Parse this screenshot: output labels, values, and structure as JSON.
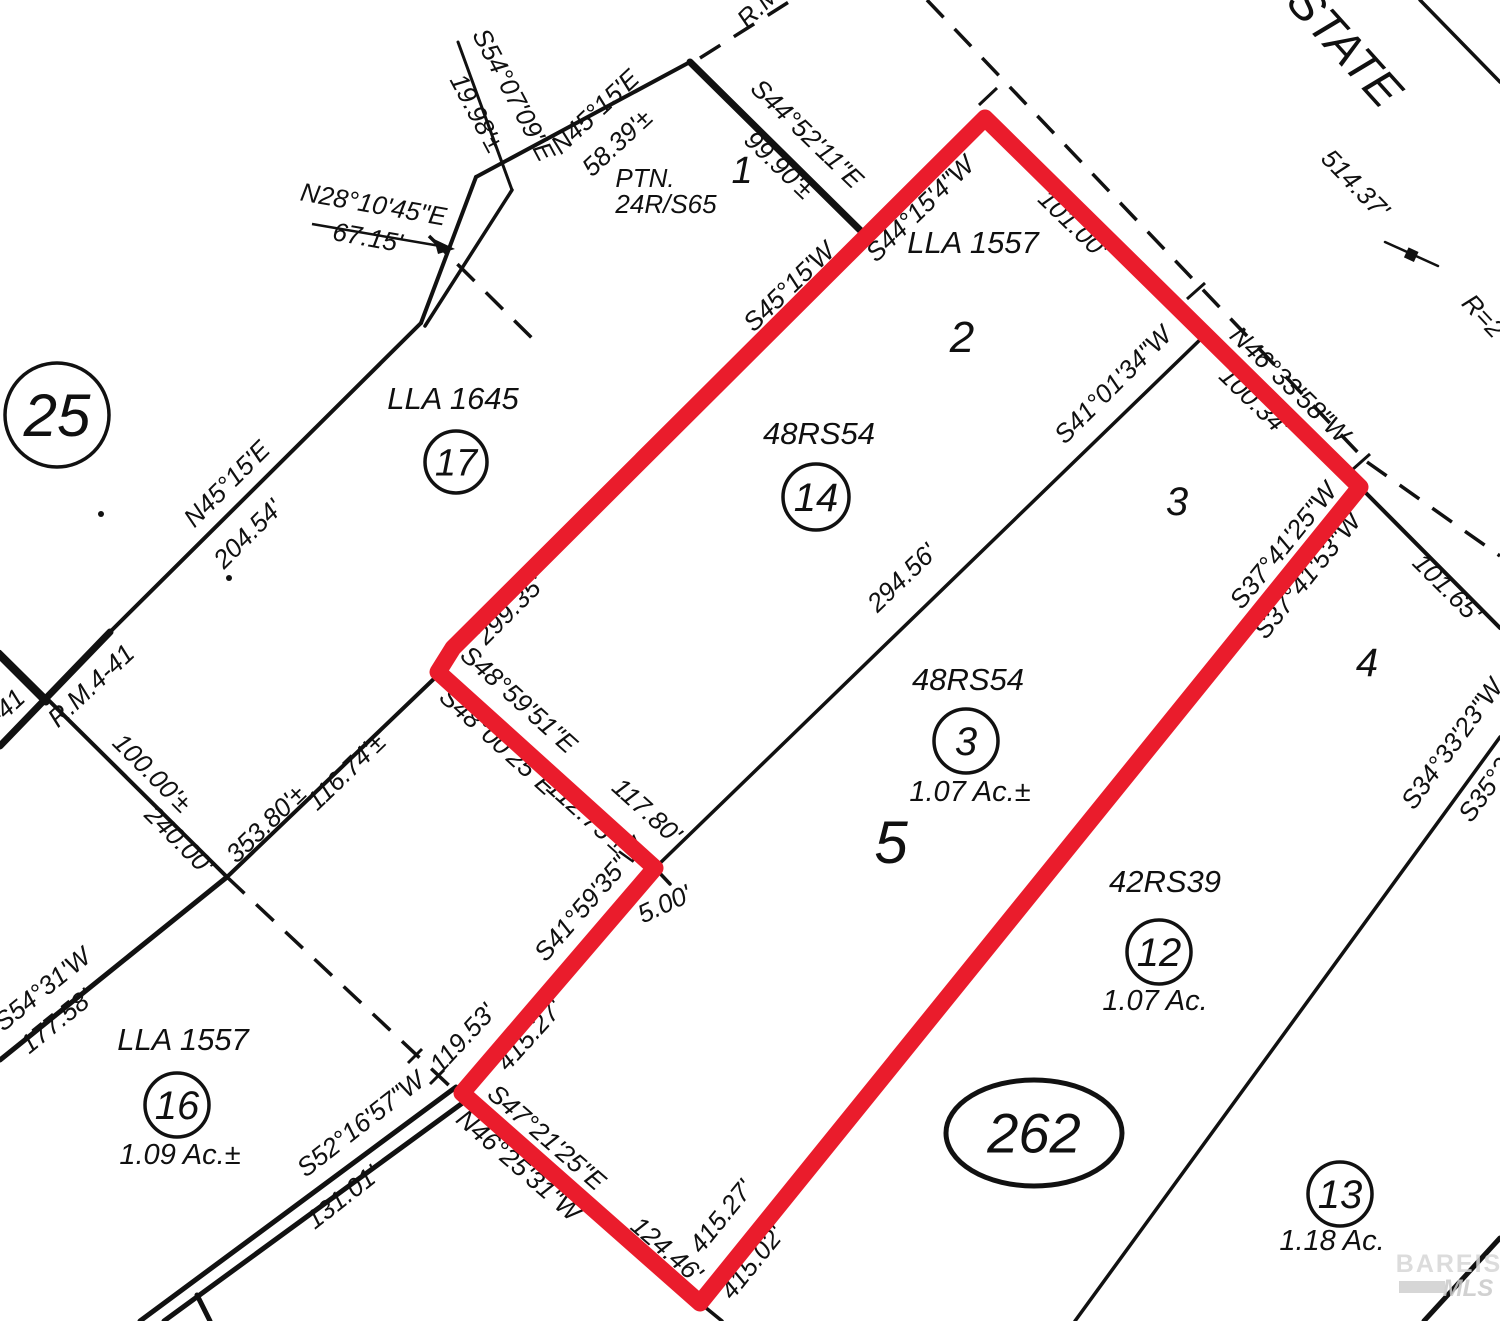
{
  "map": {
    "type": "recorded plat / parcel survey map with highlighted subject parcel",
    "colors": {
      "highlight_red": "#ea1c2c",
      "ink": "#111111",
      "paper": "#ffffff",
      "watermark_gray": "#d6d6d6"
    },
    "watermark": {
      "line1": "BAREIS",
      "line2": "MLS"
    },
    "oval": {
      "text": "262",
      "x": 1034,
      "y": 1133,
      "rx": 88,
      "ry": 53,
      "s": 56
    },
    "parcel_circles": [
      {
        "text": "25",
        "x": 57,
        "y": 415,
        "r": 52,
        "s": 60
      },
      {
        "text": "17",
        "x": 456,
        "y": 462,
        "r": 31,
        "s": 38
      },
      {
        "text": "14",
        "x": 816,
        "y": 497,
        "r": 33,
        "s": 40
      },
      {
        "text": "3",
        "x": 966,
        "y": 741,
        "r": 32,
        "s": 40
      },
      {
        "text": "16",
        "x": 177,
        "y": 1105,
        "r": 32,
        "s": 40
      },
      {
        "text": "12",
        "x": 1159,
        "y": 952,
        "r": 32,
        "s": 40
      },
      {
        "text": "13",
        "x": 1340,
        "y": 1194,
        "r": 32,
        "s": 40
      }
    ],
    "labels": [
      {
        "t": "S54°07'09\"E",
        "x": 506,
        "y": 99,
        "r": 62
      },
      {
        "t": "19.98'±",
        "x": 469,
        "y": 117,
        "r": 62
      },
      {
        "t": "N28°10'45\"E",
        "x": 372,
        "y": 213,
        "r": 10
      },
      {
        "t": "67.15'",
        "x": 366,
        "y": 246,
        "r": 10
      },
      {
        "t": "N45°15'E",
        "x": 601,
        "y": 118,
        "r": -43
      },
      {
        "t": "58.39'±",
        "x": 623,
        "y": 149,
        "r": -43
      },
      {
        "t": "PTN.",
        "x": 645,
        "y": 187,
        "r": 0
      },
      {
        "t": "24R/S65",
        "x": 666,
        "y": 213,
        "r": 0
      },
      {
        "t": "1",
        "x": 742,
        "y": 183,
        "r": 0,
        "s": 38
      },
      {
        "t": "S44°52'11\"E",
        "x": 801,
        "y": 140,
        "r": 44
      },
      {
        "t": "99.90'±",
        "x": 773,
        "y": 171,
        "r": 44
      },
      {
        "t": "R.M.",
        "x": 767,
        "y": 10,
        "r": -45
      },
      {
        "t": "S45°15'W",
        "x": 795,
        "y": 293,
        "r": -44
      },
      {
        "t": "S44°15'4\"W",
        "x": 926,
        "y": 215,
        "r": -44
      },
      {
        "t": "LLA 1557",
        "x": 973,
        "y": 253,
        "r": 0,
        "s": 31
      },
      {
        "t": "101.00'",
        "x": 1067,
        "y": 230,
        "r": 44
      },
      {
        "t": "2",
        "x": 962,
        "y": 352,
        "r": 0,
        "s": 44
      },
      {
        "t": "STATE",
        "x": 1333,
        "y": 57,
        "r": 48,
        "s": 47
      },
      {
        "t": "514.37'",
        "x": 1349,
        "y": 190,
        "r": 46
      },
      {
        "t": "R=2",
        "x": 1477,
        "y": 322,
        "r": 47
      },
      {
        "t": "N46°33'58\"W",
        "x": 1284,
        "y": 391,
        "r": 44
      },
      {
        "t": "100.34'",
        "x": 1248,
        "y": 407,
        "r": 44
      },
      {
        "t": "S41°01'34\"W",
        "x": 1119,
        "y": 391,
        "r": -45
      },
      {
        "t": "3",
        "x": 1177,
        "y": 515,
        "r": 0,
        "s": 40
      },
      {
        "t": "S37°41'25\"W",
        "x": 1290,
        "y": 551,
        "r": -51
      },
      {
        "t": "S37°41'53\"W",
        "x": 1314,
        "y": 581,
        "r": -51
      },
      {
        "t": "101.65'",
        "x": 1441,
        "y": 594,
        "r": 45
      },
      {
        "t": "4",
        "x": 1367,
        "y": 676,
        "r": 0,
        "s": 40
      },
      {
        "t": "LLA 1645",
        "x": 453,
        "y": 409,
        "r": 0,
        "s": 31
      },
      {
        "t": "N45°15'E",
        "x": 233,
        "y": 490,
        "r": -45
      },
      {
        "t": "204.54'",
        "x": 254,
        "y": 540,
        "r": -45
      },
      {
        "t": "R.M.4-41",
        "x": 97,
        "y": 692,
        "r": -43
      },
      {
        "t": "-41",
        "x": 13,
        "y": 713,
        "r": -43
      },
      {
        "t": "100.00'±",
        "x": 146,
        "y": 779,
        "r": 45
      },
      {
        "t": "240.00'",
        "x": 173,
        "y": 846,
        "r": 45
      },
      {
        "t": "353.80'±",
        "x": 272,
        "y": 830,
        "r": -44
      },
      {
        "t": "116.74'±",
        "x": 352,
        "y": 778,
        "r": -44
      },
      {
        "t": "299.35'",
        "x": 516,
        "y": 616,
        "r": -45
      },
      {
        "t": "S48°59'51\"E",
        "x": 513,
        "y": 706,
        "r": 42
      },
      {
        "t": "S48°00'25\"E",
        "x": 492,
        "y": 748,
        "r": 42
      },
      {
        "t": "112.75'±",
        "x": 581,
        "y": 822,
        "r": 42
      },
      {
        "t": "117.80'",
        "x": 641,
        "y": 817,
        "r": 42
      },
      {
        "t": "294.56'",
        "x": 908,
        "y": 584,
        "r": -44
      },
      {
        "t": "48RS54",
        "x": 819,
        "y": 444,
        "r": 0,
        "s": 31
      },
      {
        "t": "48RS54",
        "x": 968,
        "y": 690,
        "r": 0,
        "s": 31
      },
      {
        "t": "1.07 Ac.±",
        "x": 970,
        "y": 801,
        "r": 0,
        "s": 29
      },
      {
        "t": "5",
        "x": 891,
        "y": 863,
        "r": 0,
        "s": 60
      },
      {
        "t": "S41°59'35\"W",
        "x": 596,
        "y": 905,
        "r": -49
      },
      {
        "t": "5.00'",
        "x": 668,
        "y": 912,
        "r": -25
      },
      {
        "t": "119.53'",
        "x": 469,
        "y": 1044,
        "r": -47
      },
      {
        "t": "415.27'",
        "x": 536,
        "y": 1041,
        "r": -48
      },
      {
        "t": "S47°21'25\"E",
        "x": 541,
        "y": 1144,
        "r": 41
      },
      {
        "t": "N46°25'31\"W",
        "x": 513,
        "y": 1172,
        "r": 41
      },
      {
        "t": "124.46'",
        "x": 661,
        "y": 1256,
        "r": 41
      },
      {
        "t": "415.27'",
        "x": 728,
        "y": 1222,
        "r": -51
      },
      {
        "t": "415.02'",
        "x": 759,
        "y": 1268,
        "r": -51
      },
      {
        "t": "S54°31'W",
        "x": 48,
        "y": 996,
        "r": -39
      },
      {
        "t": "177.58'",
        "x": 62,
        "y": 1028,
        "r": -39
      },
      {
        "t": "LLA 1557",
        "x": 183,
        "y": 1050,
        "r": 0,
        "s": 31
      },
      {
        "t": "1.09 Ac.±",
        "x": 180,
        "y": 1164,
        "r": 0,
        "s": 29
      },
      {
        "t": "S52°16'57\"W",
        "x": 366,
        "y": 1131,
        "r": -38
      },
      {
        "t": "131.01'",
        "x": 348,
        "y": 1204,
        "r": -38
      },
      {
        "t": "42RS39",
        "x": 1165,
        "y": 892,
        "r": 0,
        "s": 31
      },
      {
        "t": "1.07 Ac.",
        "x": 1155,
        "y": 1010,
        "r": 0,
        "s": 29
      },
      {
        "t": "1.18 Ac.",
        "x": 1332,
        "y": 1250,
        "r": 0,
        "s": 29
      },
      {
        "t": "S34°33'23\"W",
        "x": 1459,
        "y": 749,
        "r": -54
      },
      {
        "t": "S35°2",
        "x": 1492,
        "y": 795,
        "r": -54
      }
    ]
  }
}
